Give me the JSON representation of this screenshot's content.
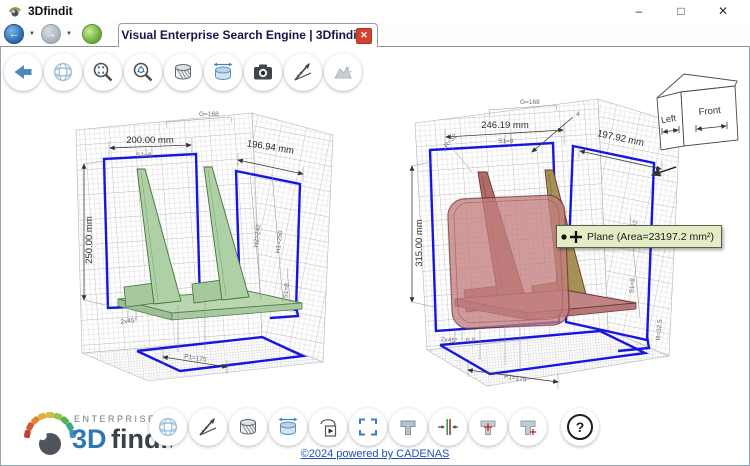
{
  "window": {
    "title": "3Dfindit"
  },
  "icons": {
    "back_glyph": "←",
    "forward_glyph": "→",
    "caret": "▼",
    "minimize": "–",
    "maximize": "□",
    "close": "✕",
    "tab_close": "✕",
    "help": "?"
  },
  "tab": {
    "title": "Visual Enterprise Search Engine | 3Dfindit"
  },
  "toolbar_top": {
    "buttons": [
      "back",
      "mesh-view",
      "zoom-fit",
      "zoom-select",
      "section-view",
      "measure-cylinder",
      "screenshot-camera",
      "measure-angle",
      "render-disabled"
    ]
  },
  "toolbar_bottom": {
    "buttons": [
      "mesh-view",
      "measure-angle",
      "section-view",
      "measure-cylinder",
      "play-animation",
      "fit-view",
      "part-solid",
      "align-parts",
      "part-point-center",
      "part-point-corner",
      "help"
    ]
  },
  "viewer": {
    "tooltip": "Plane (Area=23197.2 mm²)",
    "view_cube": {
      "left_label": "Left",
      "front_label": "Front"
    },
    "left_model": {
      "dim_g": "G=168",
      "dim_width": "200.00 mm",
      "dim_s1_top": "S1=8",
      "dim_width_right": "196.94 mm",
      "dim_height": "250.00 mm",
      "dim_h2": "H2=242",
      "dim_h1": "H1=250",
      "dim_s1_right": "S1=8",
      "dim_chamfer": "2x45°",
      "dim_p1": "P1=175"
    },
    "right_model": {
      "dim_g": "G=168",
      "dim_width": "246.19 mm",
      "dim_s1_top": "S1=8",
      "dim_r": "R=32",
      "dim_leader": "4",
      "dim_width_right": "197.92 mm",
      "dim_height": "315.00 mm",
      "dim_h_partial": "42",
      "dim_s1_right": "S1=8",
      "dim_r2": "R=32.5",
      "dim_chamfer": "2x45°",
      "dim_t": "6.8",
      "dim_p1": "P1=175"
    }
  },
  "footer": {
    "brand": {
      "enterprise": "ENTERPRISE",
      "name_3d": "3D",
      "name_findit": "findit"
    },
    "copyright": "©2024 powered by CADENAS"
  },
  "colors": {
    "blue_outline": "#1616e0",
    "part_green": "#aed0a5",
    "part_pink": "#c47f7f",
    "tooltip_bg": "#e4ecc6",
    "tab_close_bg": "#d6402f",
    "link_blue": "#1d4fc0",
    "brand_blue": "#2e75b5"
  }
}
